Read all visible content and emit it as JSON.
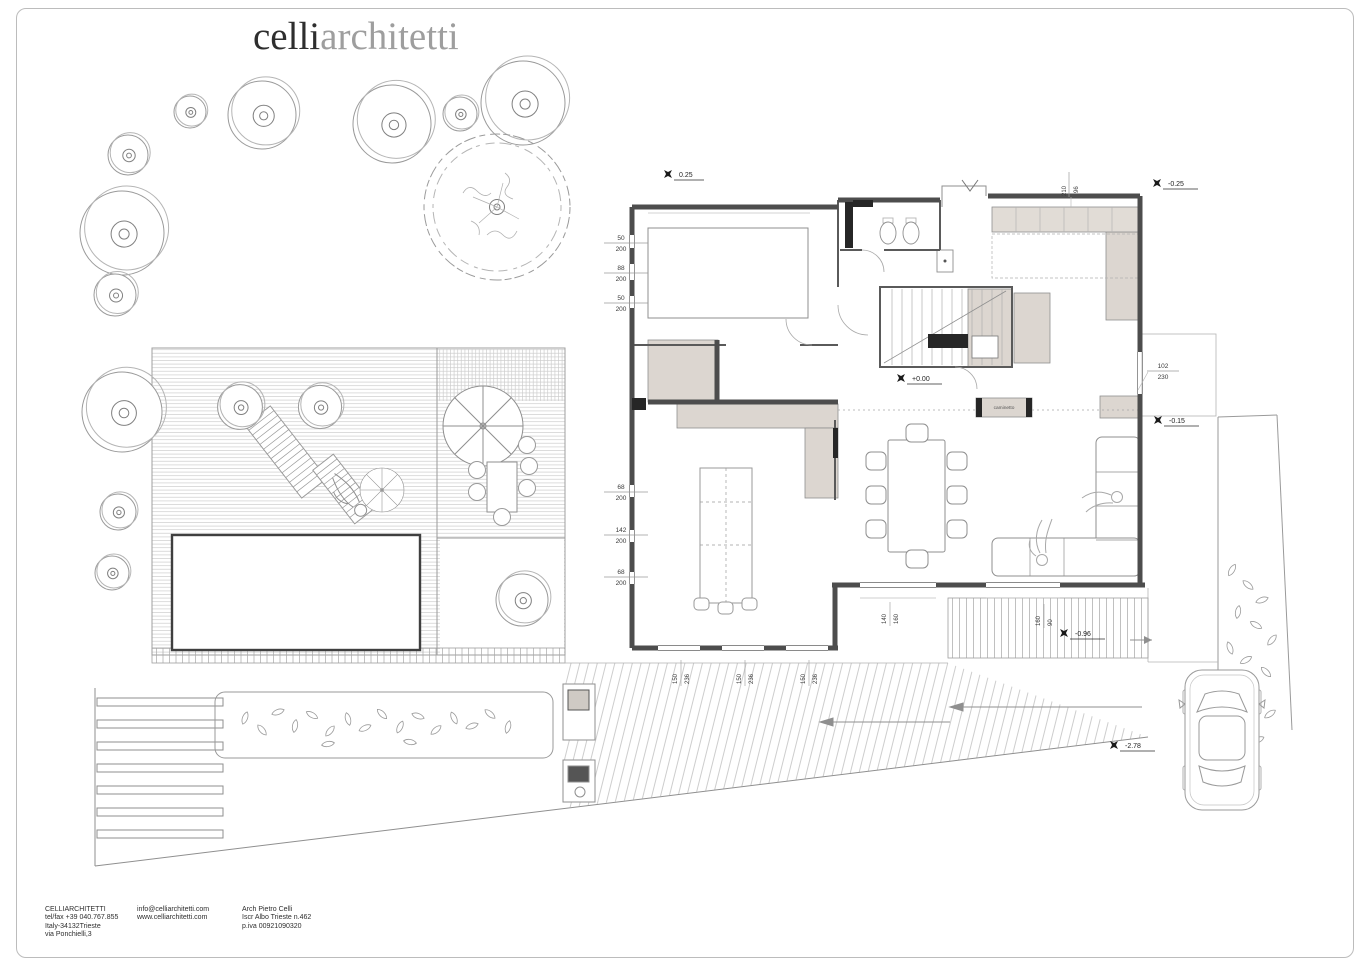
{
  "page": {
    "background": "#ffffff",
    "border_color": "#bcbcbc"
  },
  "logo": {
    "black_part": "celli",
    "gray_part": "architetti",
    "black_color": "#2e2e2e",
    "gray_color": "#9e9e9e"
  },
  "plan": {
    "levels": {
      "front_terrace": "0.25",
      "rear_terrace": "-0.25",
      "ground_floor": "+0.00",
      "side_terrace": "-0.15",
      "rear_garden": "-0.96",
      "driveway": "-2.78"
    },
    "room_labels": {
      "fireplace": "caminetto"
    },
    "dimensions": {
      "left_upper_windows": [
        {
          "w": "50",
          "h": "200"
        },
        {
          "w": "88",
          "h": "200"
        },
        {
          "w": "50",
          "h": "200"
        }
      ],
      "left_lower_windows": [
        {
          "w": "68",
          "h": "200"
        },
        {
          "w": "142",
          "h": "200"
        },
        {
          "w": "68",
          "h": "200"
        }
      ],
      "top_right_window": {
        "w": "210",
        "h": "96"
      },
      "side_door": {
        "w": "102",
        "h": "230"
      },
      "south_windows": [
        {
          "w": "150",
          "h": "236"
        },
        {
          "w": "150",
          "h": "236"
        },
        {
          "w": "150",
          "h": "236"
        }
      ],
      "terrace_openings": [
        {
          "w": "140",
          "h": "160"
        },
        {
          "w": "160",
          "h": "90"
        }
      ]
    },
    "colors": {
      "wall": "#4d4d4d",
      "furniture_fill": "#dcd6d0",
      "line_light": "#b5b5b5"
    }
  },
  "footer": {
    "studio": {
      "name": "CELLIARCHITETTI",
      "telfax": "tel/fax +39 040.767.855",
      "city": "Italy-34132Trieste",
      "street": "via Ponchielli,3"
    },
    "web": {
      "email": "info@celliarchitetti.com",
      "site": "www.celliarchitetti.com"
    },
    "architect": {
      "name": "Arch Pietro Celli",
      "register": "Iscr Albo Trieste n.462",
      "vat": "p.iva 00921090320"
    }
  }
}
